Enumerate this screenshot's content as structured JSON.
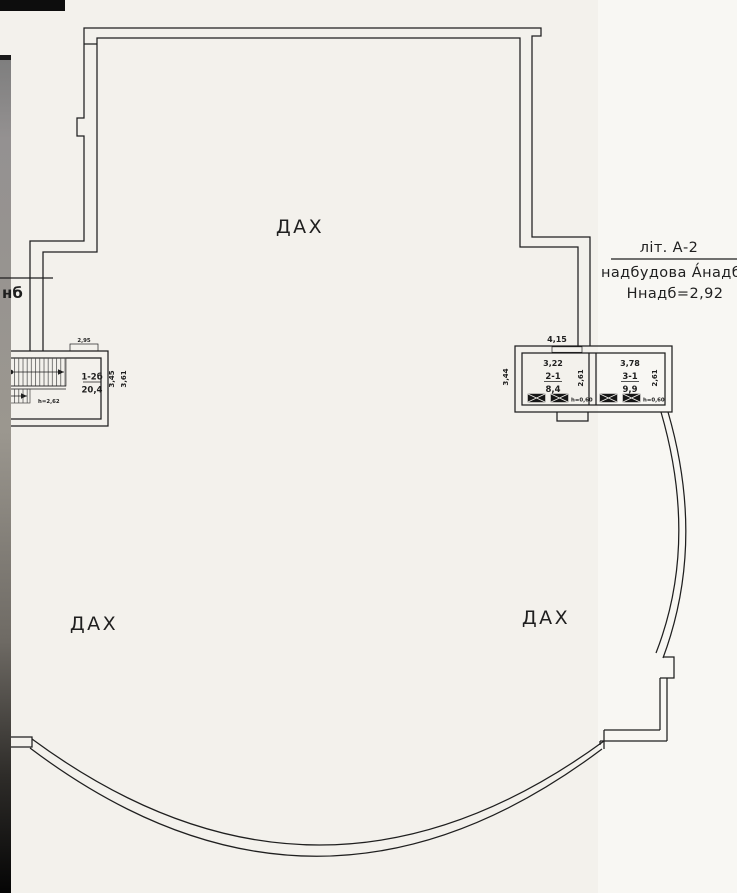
{
  "colors": {
    "paper": "#f3f1ec",
    "paper_light": "#f8f7f3",
    "ink": "#1f1f1f",
    "hatch": "#3a3a3a",
    "gutter_dark": "#0d0d0d"
  },
  "roof_labels": {
    "top": "ДАХ",
    "left": "ДАХ",
    "right": "ДАХ"
  },
  "callout": {
    "line1": "літ. А-2",
    "line2": "надбудова А́надб",
    "line3": "Ннадб=2,92"
  },
  "edge_label": "нб",
  "stairwell": {
    "dim_top": "2,95",
    "unit_number": "1-2б",
    "area": "20,4",
    "dim_side_inner": "3,45",
    "dim_side_outer": "3,61",
    "height_note": "h=2,62"
  },
  "annex": {
    "dim_top": "4,15",
    "dim_left": "3,44",
    "room_a": {
      "width": "3,22",
      "number": "2-1",
      "area": "8,4",
      "depth": "2,61",
      "window_note": "h=0,60"
    },
    "room_b": {
      "width": "3,78",
      "number": "3-1",
      "area": "9,9",
      "depth": "2,61",
      "window_note": "h=0,60"
    }
  }
}
